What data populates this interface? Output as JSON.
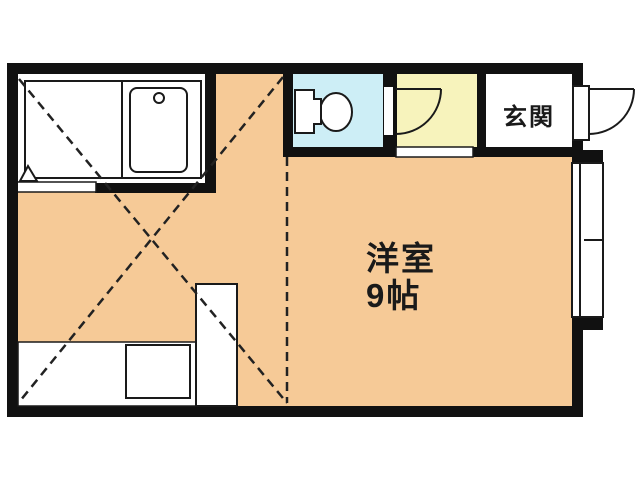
{
  "floorplan": {
    "labels": {
      "entrance": "玄関",
      "room_name": "洋室",
      "room_size": "9帖"
    },
    "colors": {
      "wall": "#111111",
      "floor": "#f6ca97",
      "toilet_room": "#cdeef6",
      "bathroom": "#f7f3bc",
      "background": "#ffffff",
      "line": "#1a1a1a"
    }
  }
}
